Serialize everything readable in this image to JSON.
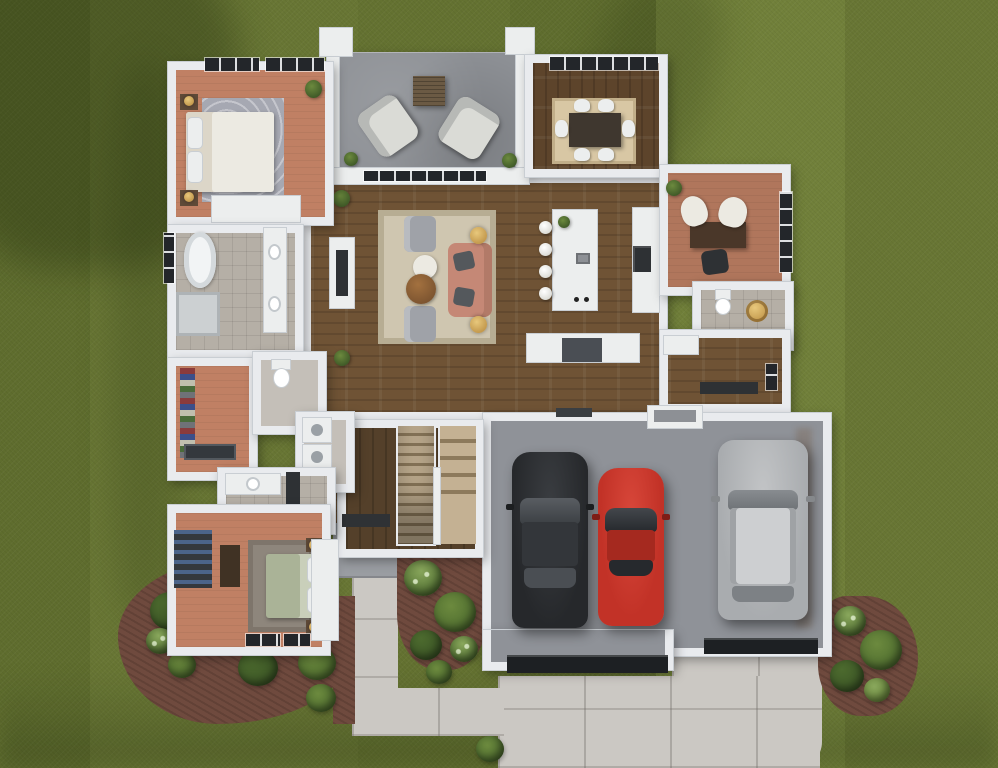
{
  "scene": {
    "type": "3d-floor-plan-render",
    "view": "top-down",
    "description": "Photorealistic top-down rendering of a furnished single-story house with open patio, three-car garage, driveway, walkways and landscaped lawn",
    "rooms": [
      {
        "id": "primary-bedroom"
      },
      {
        "id": "primary-bathroom"
      },
      {
        "id": "walk-in-closet"
      },
      {
        "id": "water-closet"
      },
      {
        "id": "laundry"
      },
      {
        "id": "second-bathroom"
      },
      {
        "id": "second-bedroom"
      },
      {
        "id": "open-patio"
      },
      {
        "id": "living-room"
      },
      {
        "id": "kitchen"
      },
      {
        "id": "dining-room"
      },
      {
        "id": "office"
      },
      {
        "id": "powder-bath"
      },
      {
        "id": "mudroom-hall"
      },
      {
        "id": "stair-hall"
      },
      {
        "id": "garage"
      }
    ],
    "vehicles": [
      {
        "id": "black-sedan",
        "color": "#26282b"
      },
      {
        "id": "red-coupe",
        "color": "#c23227"
      },
      {
        "id": "silver-suv",
        "color": "#a9acaf"
      }
    ],
    "landscape": [
      "lawn-with-mow-stripes",
      "mulch-beds",
      "shrubs",
      "front-walkway",
      "driveway"
    ]
  },
  "palette": {
    "grassA": "#71803a",
    "grassB": "#687634",
    "grassC": "#5f6d2e",
    "grassC2": "#647231",
    "wall": "#e9ebee",
    "wallShade": "#c9ced3",
    "white": "#eceeee",
    "woodMain": "#6f5335",
    "woodDark": "#54402a",
    "woodDining": "#5d442b",
    "floorSalmon": "#c08064",
    "floorSalmon2": "#b0765c",
    "tileFloor": "#b5afa6",
    "patio": "#8d9095",
    "garageFloor": "#8f9298",
    "concrete": "#cbc8c3",
    "porch": "#9a9da2",
    "mulch": "#6f4a3e",
    "bushDark": "#3c5626",
    "bushMid": "#4c6a2e",
    "bushLight": "#6c8a3e",
    "bushPale": "#89a75c",
    "darkGlass": "#23262a",
    "carBlack": "#26282b",
    "carRed": "#c23227",
    "carSilver": "#a9acaf",
    "glass": "#54585c",
    "gold": "#c49a4e",
    "rugLiving": "#cfc6b0",
    "rugDining": "#d8c7a4",
    "rugGray": "#a6a8b2",
    "rugTaupe": "#8e867c",
    "bedWhite": "#eceae2",
    "bedSage": "#aab397",
    "sofa": "#c58876",
    "chairGray": "#9fa2a8",
    "furnDark": "#3f372f",
    "counterDark": "#4a4e54",
    "applianceDark": "#2e3134",
    "stairLight": "#c4b193",
    "stairDark": "#8d7a5c",
    "doorStrip": "#1d2023",
    "closetDark": "#34383d"
  }
}
